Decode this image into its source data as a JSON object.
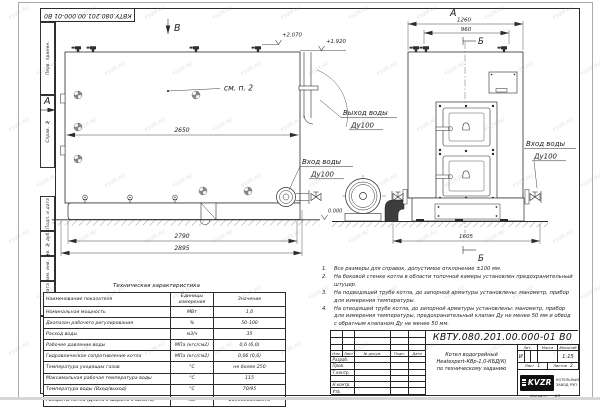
{
  "watermark": "KVZR.RU",
  "frame": {
    "top_stamp": "КВТУ.080.201.00.000-01 В0",
    "margin_labels": [
      "Перв. примен.",
      "Справ. №",
      "Подп. и дата",
      "Инв. № дубл.",
      "Взам. инв. №",
      "Подп. и дата",
      "Инв. № подл."
    ],
    "format_label": "Формат",
    "format_value": "А3"
  },
  "views": {
    "side_label": "В",
    "front_label": "А",
    "left_arrow_label": "А",
    "section_top": "Б",
    "section_bottom": "Б",
    "see_note": "см. п. 2",
    "dim_2650": "2650",
    "dim_2790": "2790",
    "dim_2895": "2895",
    "dim_1260": "1260",
    "dim_960": "960",
    "dim_1605": "1605",
    "elev_2070": "+2.070",
    "elev_1920": "+1.920",
    "elev_0": "0.000",
    "outlet_label": "Выход воды",
    "outlet_dn": "Ду100",
    "inlet_left_label": "Вход воды",
    "inlet_left_dn": "Ду100",
    "inlet_right_label": "Вход воды",
    "inlet_right_dn": "Ду100"
  },
  "notes": {
    "items": [
      {
        "num": "1.",
        "text": "Все размеры для справок, допустимое отклонение ±100 мм."
      },
      {
        "num": "2.",
        "text": "На боковой стенке котла в области топочной камеры установлен предохранительный штуцер."
      },
      {
        "num": "3.",
        "text": "На подводящей трубе котла, до запорной арматуры установлены: манометр, прибор для измерения температуры."
      },
      {
        "num": "4.",
        "text": "На отводящей трубе котла, до запорной арматуры установлены: манометр, прибор для измерения температуры, предохранительный клапан Ду не менее 50 мм и обвод с обратным клапаном Ду не менее 50 мм."
      }
    ]
  },
  "spec_table": {
    "title": "Техническая характеристика",
    "headers": {
      "name": "Наименование показателя",
      "units": "Единицы измерения",
      "value": "Значение"
    },
    "rows": [
      {
        "name": "Номинальная мощность",
        "units": "МВт",
        "value": "1,0"
      },
      {
        "name": "Диапазон рабочего регулирования",
        "units": "%",
        "value": "50-100"
      },
      {
        "name": "Расход воды",
        "units": "м3/ч",
        "value": "35"
      },
      {
        "name": "Рабочее давление воды",
        "units": "МПа (кгс/см2)",
        "value": "0,6 (6,0)"
      },
      {
        "name": "Гидравлическое сопротивление котла",
        "units": "МПа (кгс/см2)",
        "value": "0,06 (0,6)"
      },
      {
        "name": "Температура уходящих газов",
        "units": "°С",
        "value": "не более 250"
      },
      {
        "name": "Максимальная рабочая температура воды",
        "units": "°С",
        "value": "115"
      },
      {
        "name": "Температура воды (Вход/выход)",
        "units": "°С",
        "value": "70/95"
      },
      {
        "name": "Габариты котла (Длина х ширина х высота)",
        "units": "мм",
        "value": "2895х1605х2070"
      }
    ]
  },
  "title_block": {
    "doc_number": "КВТУ.080.201.00.000-01 В0",
    "rev_headers": {
      "izm": "Изм.",
      "list": "Лист",
      "doc": "№ докум.",
      "podp": "Подп.",
      "data": "Дата"
    },
    "sign_rows": [
      "Разраб.",
      "Пров.",
      "Т.контр.",
      "",
      "Н.контр.",
      "Утв."
    ],
    "description_line1": "Котел водогрейный",
    "description_line2": "Heatexpert-КВр-1,0-КБД(К)",
    "description_line3": "по техническому заданию",
    "lit_label": "Лит.",
    "lit_value": "И",
    "mass_label": "Масса",
    "scale_label": "Масштаб",
    "scale_value": "1:15",
    "sheet_label": "Лист",
    "sheet_value": "1",
    "sheets_label": "Листов",
    "sheets_value": "2",
    "company_logo": "KVZR",
    "company_line1": "КОТЕЛЬНЫЙ",
    "company_line2": "ЗАВОД РЭП"
  }
}
